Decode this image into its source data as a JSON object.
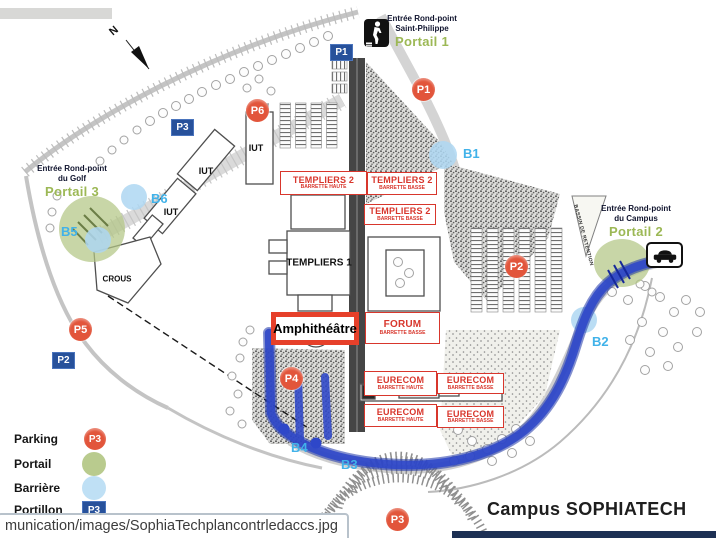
{
  "title": {
    "campus": "Campus SOPHIATECH"
  },
  "status_bar": {
    "url_text": "munication/images/SophiaTechplancontrledaccs.jpg"
  },
  "compass": {
    "north": "N"
  },
  "entrances": {
    "saint_philippe": {
      "line1": "Entrée Rond-point",
      "line2": "Saint-Philippe",
      "portal": "Portail 1"
    },
    "campus": {
      "line1": "Entrée Rond-point",
      "line2": "du Campus",
      "portal": "Portail 2"
    },
    "golf": {
      "line1": "Entrée Rond-point",
      "line2": "du Golf",
      "portal": "Portail 3"
    }
  },
  "markers": {
    "parking": [
      {
        "label": "P1"
      },
      {
        "label": "P2"
      },
      {
        "label": "P3"
      },
      {
        "label": "P4"
      },
      {
        "label": "P5"
      },
      {
        "label": "P6"
      }
    ],
    "portillons": [
      {
        "label": "P1"
      },
      {
        "label": "P2"
      },
      {
        "label": "P3"
      }
    ],
    "barriers": [
      {
        "label": "B1"
      },
      {
        "label": "B2"
      },
      {
        "label": "B3"
      },
      {
        "label": "B4"
      },
      {
        "label": "B5"
      },
      {
        "label": "B6"
      }
    ]
  },
  "buildings": {
    "iut": "IUT",
    "crous": "CROUS",
    "templiers1": "TEMPLIERS 1",
    "amphitheatre": "Amphithéâtre",
    "bassin": "BASSIN DE RETENTION"
  },
  "access_boxes": [
    {
      "title": "TEMPLIERS 2",
      "subtitle": "BARRETTE HAUTE"
    },
    {
      "title": "TEMPLIERS 2",
      "subtitle": "BARRETTE BASSE"
    },
    {
      "title": "TEMPLIERS 2",
      "subtitle": "BARRETTE BASSE"
    },
    {
      "title": "FORUM",
      "subtitle": "BARRETTE BASSE"
    },
    {
      "title": "EURECOM",
      "subtitle": "BARRETTE HAUTE"
    },
    {
      "title": "EURECOM",
      "subtitle": "BARRETTE BASSE"
    },
    {
      "title": "EURECOM",
      "subtitle": "BARRETTE HAUTE"
    },
    {
      "title": "EURECOM",
      "subtitle": "BARRETTE BASSE"
    }
  ],
  "legend": {
    "items": [
      {
        "label": "Parking",
        "badge": "P3"
      },
      {
        "label": "Portail"
      },
      {
        "label": "Barrière"
      },
      {
        "label": "Portillon",
        "badge": "P3"
      }
    ]
  },
  "colors": {
    "parking_marker": "#e2553b",
    "portail_circle": "#b9cb8e",
    "barriere_circle": "#aed7f2",
    "portillon_square": "#27519b",
    "barrier_label": "#41b2e9",
    "portal_label": "#9cb855",
    "route_blue": "#2e47c9",
    "access_box_red": "#d8362c"
  }
}
